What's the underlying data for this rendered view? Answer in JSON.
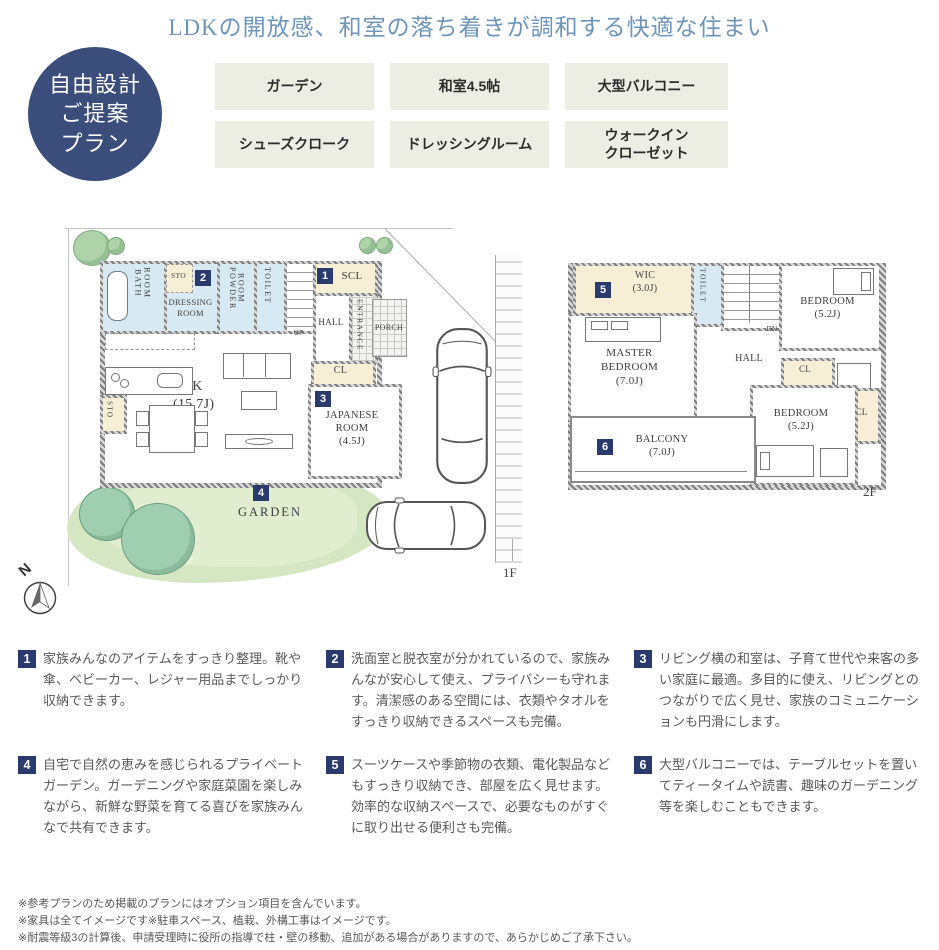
{
  "header": {
    "title": "LDKの開放感、和室の落ち着きが調和する快適な住まい",
    "badge": {
      "line1": "自由設計",
      "line2": "ご提案",
      "line3": "プラン"
    },
    "tags": [
      "ガーデン",
      "和室4.5帖",
      "大型バルコニー",
      "シューズクローク",
      "ドレッシングルーム",
      "ウォークイン\nクローゼット"
    ]
  },
  "plan_1f": {
    "floor_label": "1F",
    "compass_label": "N",
    "rooms": {
      "bath": "BATH\nROOM",
      "sto_top": "STO",
      "dressing": "DRESSING\nROOM",
      "powder": "POWDER\nROOM",
      "toilet": "TOILET",
      "up": "UP",
      "scl": "SCL",
      "hall": "HALL",
      "entrance": "ENTRANCE",
      "porch": "PORCH",
      "cl": "CL",
      "ldk": "LDK\n(15.7J)",
      "sto_kitchen": "STO",
      "japanese": "JAPANESE\nROOM\n(4.5J)",
      "garden": "GARDEN"
    },
    "markers": {
      "scl": "1",
      "dressing": "2",
      "japanese": "3",
      "garden": "4"
    }
  },
  "plan_2f": {
    "floor_label": "2F",
    "rooms": {
      "wic": "WIC\n(3.0J)",
      "toilet": "TOILET",
      "dn": "DN",
      "bedroom1": "BEDROOM\n(5.2J)",
      "master": "MASTER\nBEDROOM\n(7.0J)",
      "hall": "HALL",
      "cl_mid": "CL",
      "cl_right": "CL",
      "balcony": "BALCONY\n(7.0J)",
      "bedroom2": "BEDROOM\n(5.2J)"
    },
    "markers": {
      "wic": "5",
      "balcony": "6"
    }
  },
  "features": [
    {
      "num": "1",
      "text": "家族みんなのアイテムをすっきり整理。靴や傘、ベビーカー、レジャー用品までしっかり収納できます。"
    },
    {
      "num": "2",
      "text": "洗面室と脱衣室が分かれているので、家族みんなが安心して使え、プライバシーも守れます。清潔感のある空間には、衣類やタオルをすっきり収納できるスペースも完備。"
    },
    {
      "num": "3",
      "text": "リビング横の和室は、子育て世代や来客の多い家庭に最適。多目的に使え、リビングとのつながりで広く見せ、家族のコミュニケーションも円滑にします。"
    },
    {
      "num": "4",
      "text": "自宅で自然の恵みを感じられるプライベートガーデン。ガーデニングや家庭菜園を楽しみながら、新鮮な野菜を育てる喜びを家族みんなで共有できます。"
    },
    {
      "num": "5",
      "text": "スーツケースや季節物の衣類、電化製品などもすっきり収納でき、部屋を広く見せます。効率的な収納スペースで、必要なものがすぐに取り出せる便利さも完備。"
    },
    {
      "num": "6",
      "text": "大型バルコニーでは、テーブルセットを置いてティータイムや読書、趣味のガーデニング等を楽しむこともできます。"
    }
  ],
  "footnotes": [
    "※参考プランのため掲載のプランにはオプション項目を含んでいます。",
    "※家具は全てイメージです※駐車スペース、植栽、外構工事はイメージです。",
    "※耐震等級3の計算後、申請受理時に役所の指導で柱・壁の移動、追加がある場合がありますので、あらかじめご了承下さい。"
  ],
  "colors": {
    "title_blue": "#6e96b8",
    "badge_navy": "#3b4d7a",
    "marker_navy": "#2b3a6d",
    "tag_beige": "#edeee3",
    "closet_beige": "#f7eed6",
    "wet_blue": "#d7e9f2",
    "garden_green": "#d5e6c2"
  }
}
